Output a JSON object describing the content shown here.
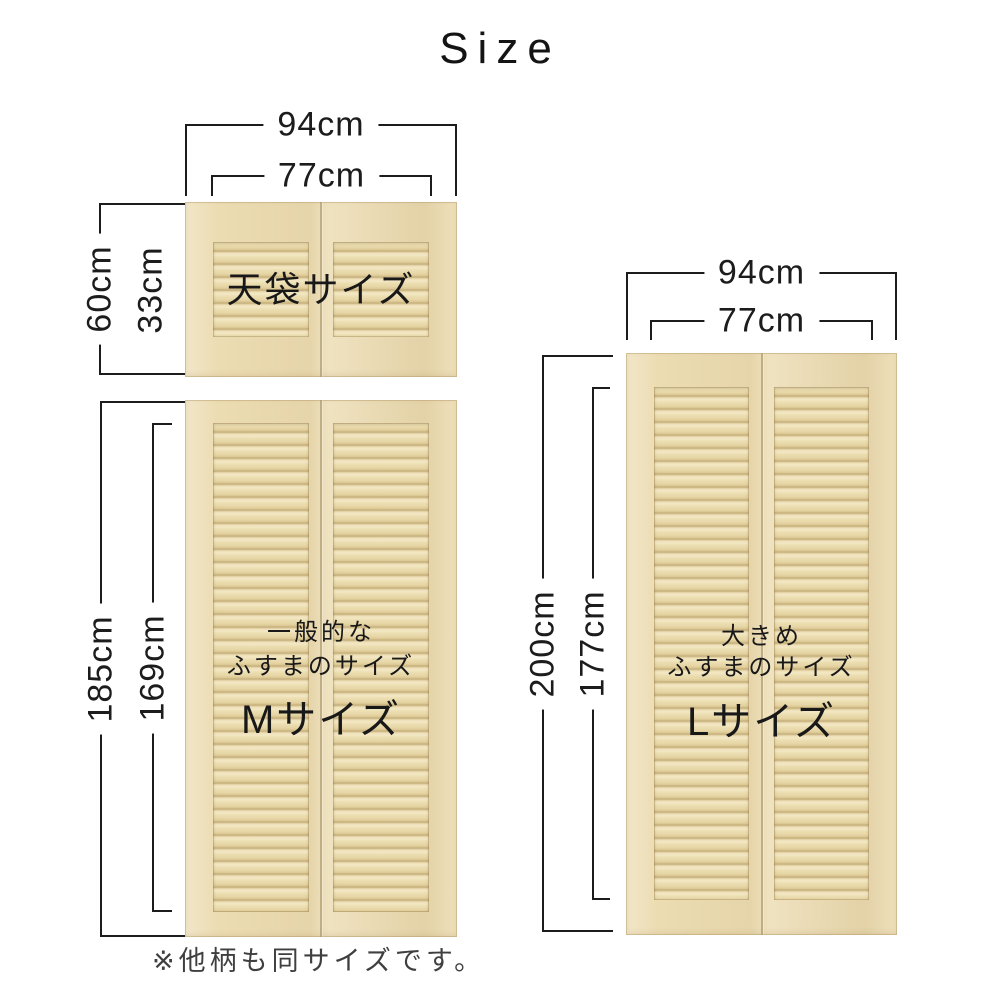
{
  "title": "Size",
  "footer_note": "※他柄も同サイズです。",
  "left_group": {
    "width_outer": "94cm",
    "width_inner": "77cm",
    "tenbukuro_door": {
      "label": "天袋サイズ",
      "height_outer": "60cm",
      "height_inner": "33cm"
    },
    "m_door": {
      "desc_line1": "一般的な",
      "desc_line2": "ふすまのサイズ",
      "size_label": "Mサイズ",
      "height_outer": "185cm",
      "height_inner": "169cm"
    }
  },
  "right_group": {
    "width_outer": "94cm",
    "width_inner": "77cm",
    "l_door": {
      "desc_line1": "大きめ",
      "desc_line2": "ふすまのサイズ",
      "size_label": "Lサイズ",
      "height_outer": "200cm",
      "height_inner": "177cm"
    }
  },
  "colors": {
    "text": "#1c1c1c",
    "dimension_line": "#1c1c1c",
    "background": "#ffffff",
    "wood_light": "#f4e8c6",
    "wood_base": "#ecdcb2",
    "wood_slat_shadow": "#c2ab78",
    "wood_seam": "#a8946a",
    "footer_text": "#3f3f3f"
  }
}
